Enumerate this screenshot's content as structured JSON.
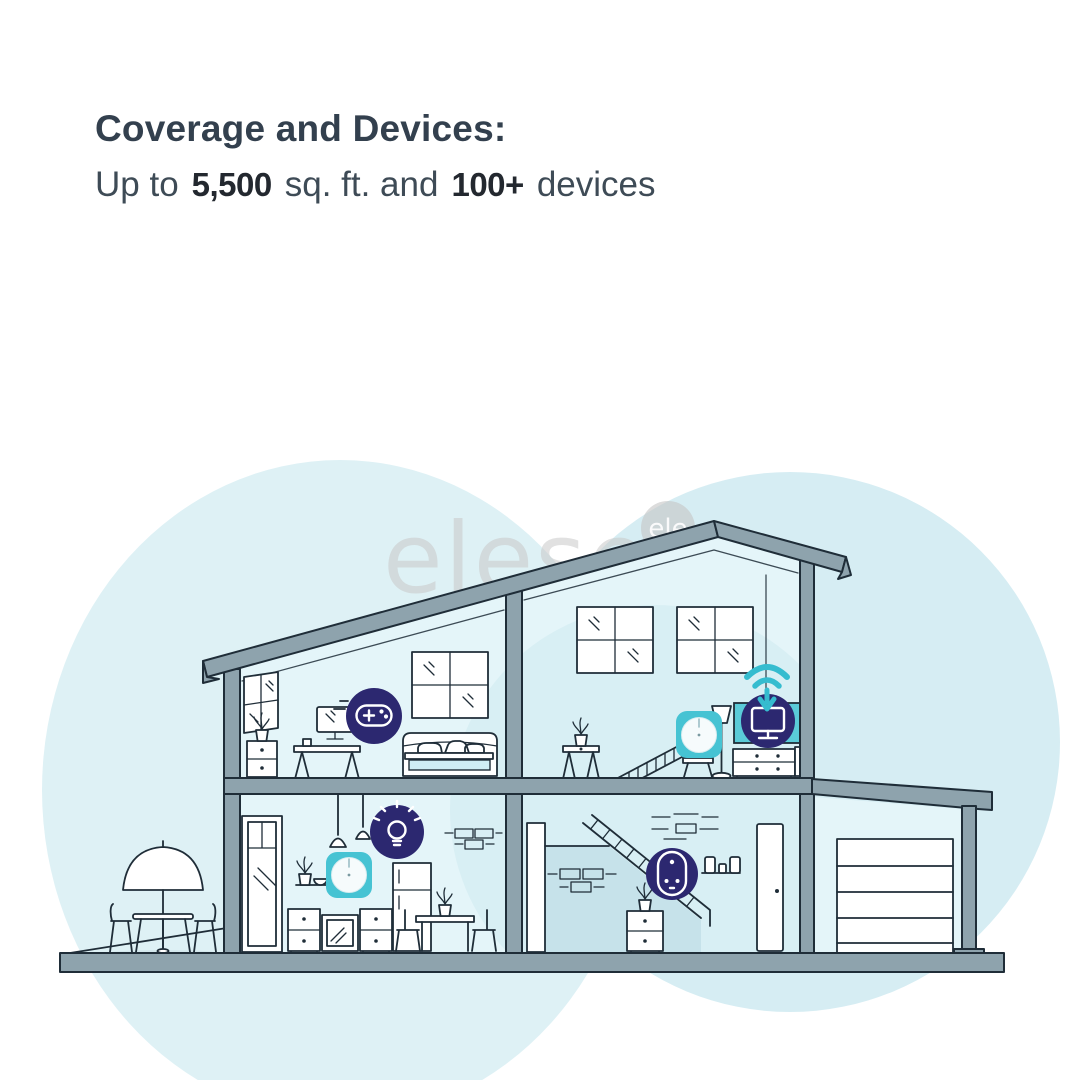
{
  "headline": {
    "title": "Coverage and Devices:",
    "prefix": "Up to",
    "coverage_value": "5,500",
    "middle": "sq. ft. and",
    "devices_value": "100+",
    "suffix": "devices"
  },
  "watermark": {
    "text": "elesen",
    "badge": "ele"
  },
  "illustration": {
    "type": "two-story-house-cross-section-with-garage",
    "mesh_units_visible": 2,
    "icons": [
      "game-controller-icon",
      "light-bulb-icon",
      "tv-icon",
      "wifi-icon",
      "smart-plug-icon",
      "mesh-router-unit-upstairs",
      "mesh-router-unit-kitchen"
    ]
  },
  "colors": {
    "title_text": "#33404e",
    "body_text": "#3e4b56",
    "icon_navy": "#2c2870",
    "accent_teal": "#46c3d3",
    "wifi_teal": "#35bccf",
    "tv_screen_teal": "#5acbd8",
    "wall_gray": "#8ea3ad",
    "room_fill": "#e4f5f9",
    "coverage_glow": "#cdeaf1",
    "under_stair_shade": "#c6e2ea",
    "background_blob": "#d9eef3",
    "outline": "#1f2d38",
    "watermark_gray": "#c9c9c9"
  }
}
